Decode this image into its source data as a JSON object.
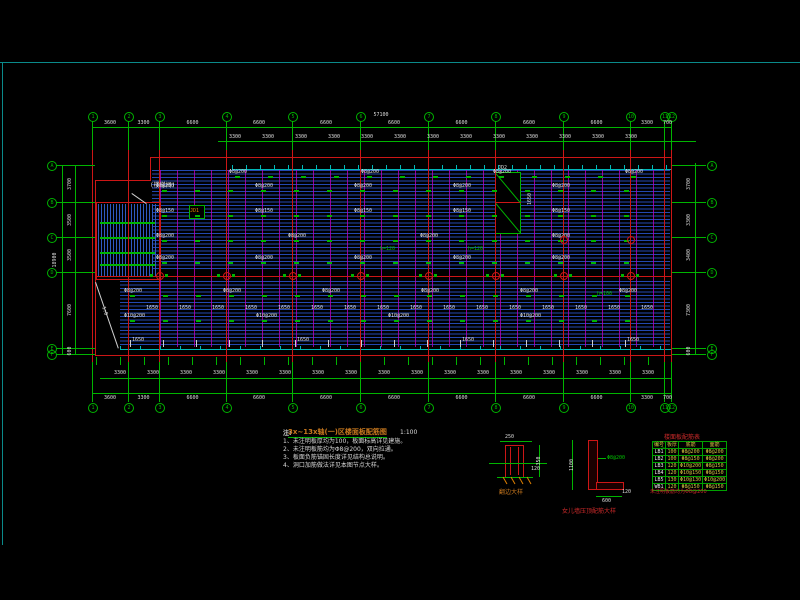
{
  "title": {
    "text": "3x~13x轴(一)区楼面板配筋图",
    "scale": "1:100"
  },
  "notes": {
    "header": "注:",
    "lines": [
      "1、未注明板厚均为100，板面标高详见建施。",
      "2、未注明板筋均为Φ8@200，双向拉通。",
      "3、板面负筋锚固长度详见结构总说明。",
      "4、洞口加筋做法详见本图节点大样。"
    ]
  },
  "labels": {
    "stair": "(楼梯间)",
    "ramp": "1:8",
    "opening_small": "JD1",
    "opening_large": "JD2",
    "opening_dim": "1650",
    "green_notes": [
      {
        "x": 380,
        "y": 246,
        "text": "h=120"
      },
      {
        "x": 468,
        "y": 246,
        "text": "h=120"
      },
      {
        "x": 597,
        "y": 291,
        "text": "h=100"
      }
    ]
  },
  "details": {
    "flange": {
      "caption": "翻边大样",
      "dim_top": "250",
      "dim_side": "350",
      "dim_slab": "120"
    },
    "parapet": {
      "caption": "女儿墙压顶配筋大样",
      "dim_height": "1100",
      "dim_leg": "600",
      "dim_thick": "120",
      "rebar": "Φ8@200"
    }
  },
  "table": {
    "title": "楼面板配筋表",
    "header": [
      "编号",
      "板厚",
      "底筋",
      "面筋"
    ],
    "rows": [
      [
        "LB1",
        "100",
        "Φ8@200",
        "Φ8@200"
      ],
      [
        "LB2",
        "100",
        "Φ8@150",
        "Φ8@200"
      ],
      [
        "LB3",
        "120",
        "Φ10@200",
        "Φ8@150"
      ],
      [
        "LB4",
        "120",
        "Φ10@150",
        "Φ8@150"
      ],
      [
        "LB5",
        "130",
        "Φ10@130",
        "Φ10@200"
      ],
      [
        "WB1",
        "120",
        "Φ8@150",
        "Φ8@150"
      ]
    ],
    "footnote": "未注明板筋均为Φ8@200"
  },
  "plan": {
    "grid_x": [
      92,
      128,
      159,
      226,
      292,
      360,
      428,
      495,
      563,
      630,
      664,
      671
    ],
    "grid_x_labels": [
      "1",
      "2",
      "3",
      "4",
      "5",
      "6",
      "7",
      "8",
      "9",
      "10",
      "11",
      "12"
    ],
    "grid_y": [
      165,
      202,
      237,
      272,
      348,
      354
    ],
    "grid_y_labels": [
      "A",
      "B",
      "C",
      "D",
      "E",
      "F"
    ],
    "top_dims": [
      "3600",
      "3300",
      "6600",
      "6600",
      "6600",
      "6600",
      "6600",
      "6600",
      "6600",
      "3300",
      "700"
    ],
    "top_overall": "57100",
    "sub_dim": "3300",
    "left_dims": [
      "3700",
      "3500",
      "3500",
      "7600",
      "600"
    ],
    "left_overall": "18900",
    "right_dims": [
      "3700",
      "3300",
      "3400",
      "7300",
      "600"
    ],
    "rebar_rows": [
      {
        "y": 176,
        "x0": 235,
        "step": 33,
        "label": "Φ8@200",
        "every": 4,
        "type": "mark"
      },
      {
        "y": 190,
        "x0": 162,
        "step": 33,
        "label": "Φ8@200",
        "every": 3,
        "type": "mark"
      },
      {
        "y": 215,
        "x0": 162,
        "step": 33,
        "label": "Φ8@150",
        "every": 3,
        "type": "mark"
      },
      {
        "y": 240,
        "x0": 162,
        "step": 33,
        "label": "Φ8@200",
        "every": 4,
        "type": "mark"
      },
      {
        "y": 262,
        "x0": 162,
        "step": 33,
        "label": "Φ8@200",
        "every": 3,
        "type": "mark"
      },
      {
        "y": 295,
        "x0": 130,
        "step": 33,
        "label": "Φ8@200",
        "every": 3,
        "type": "mark"
      },
      {
        "y": 305,
        "x0": 146,
        "step": 33,
        "label": "1650",
        "every": 1,
        "type": "text"
      },
      {
        "y": 320,
        "x0": 130,
        "step": 33,
        "label": "Φ10@200",
        "every": 4,
        "type": "mark"
      },
      {
        "y": 343,
        "x0": 130,
        "step": 33,
        "label": "1650",
        "every": 5,
        "type": "tick"
      }
    ],
    "column_row_y": 276,
    "extra_columns": [
      [
        563,
        240
      ],
      [
        630,
        240
      ]
    ]
  },
  "colors": {
    "green": "#00b400",
    "red": "#cc1616",
    "cyan": "#00b8b8",
    "blue": "#2348b0",
    "magenta": "#b900b9",
    "white": "#dcdcdc",
    "orange": "#e08000",
    "yellow": "#d0c040"
  }
}
